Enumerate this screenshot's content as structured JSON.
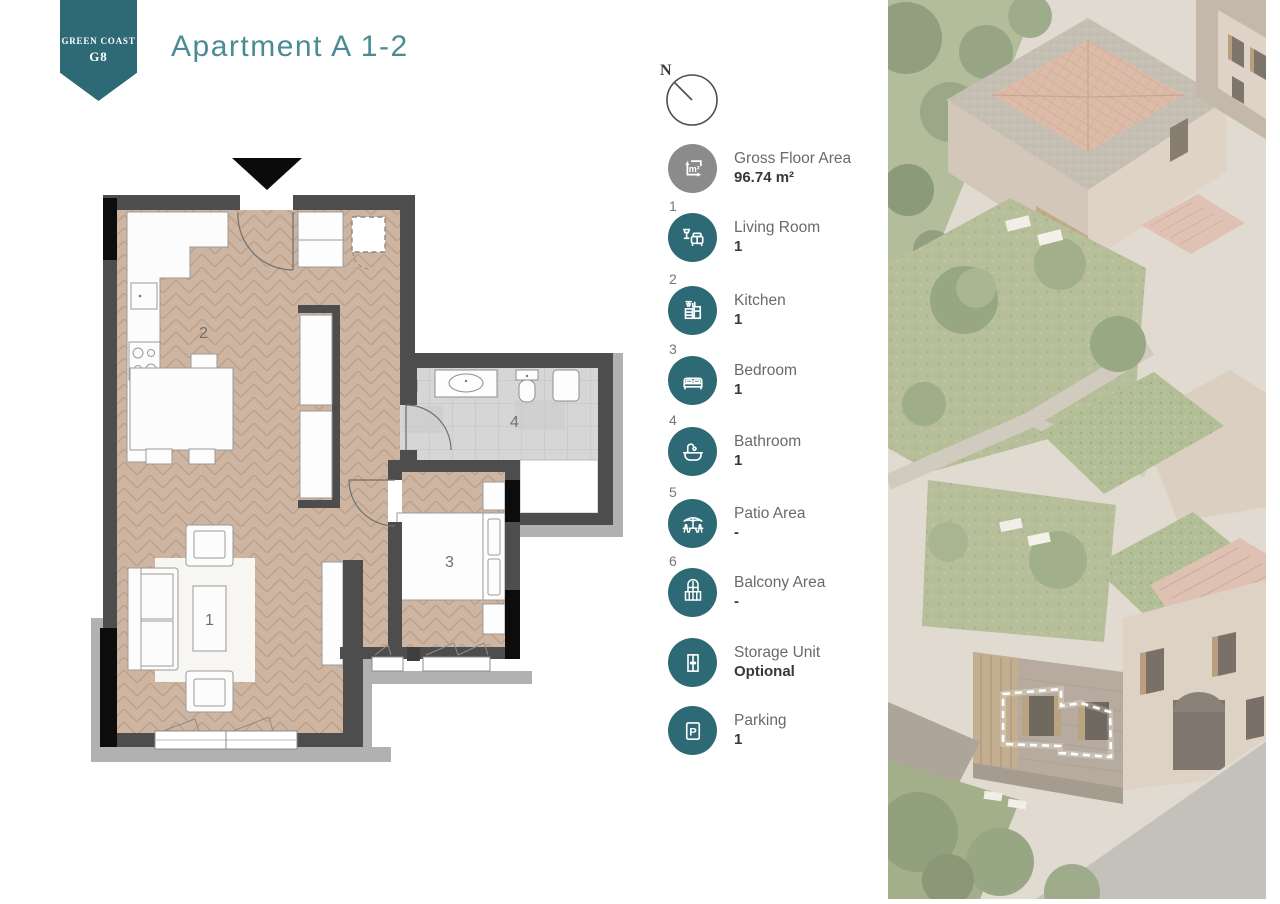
{
  "badge": {
    "line1": "GREEN COAST",
    "line2": "G8"
  },
  "title": "Apartment A 1-2",
  "compass": {
    "label": "N"
  },
  "legend": {
    "gfa": {
      "num": "",
      "label": "Gross Floor Area",
      "value": "96.74 m²",
      "icon": "area-icon"
    },
    "items": [
      {
        "num": "1",
        "label": "Living Room",
        "value": "1",
        "icon": "living-room-icon"
      },
      {
        "num": "2",
        "label": "Kitchen",
        "value": "1",
        "icon": "kitchen-icon"
      },
      {
        "num": "3",
        "label": "Bedroom",
        "value": "1",
        "icon": "bedroom-icon"
      },
      {
        "num": "4",
        "label": "Bathroom",
        "value": "1",
        "icon": "bathroom-icon"
      },
      {
        "num": "5",
        "label": "Patio Area",
        "value": "-",
        "icon": "patio-icon"
      },
      {
        "num": "6",
        "label": "Balcony Area",
        "value": "-",
        "icon": "balcony-icon"
      },
      {
        "num": "",
        "label": "Storage Unit",
        "value": "Optional",
        "icon": "storage-icon"
      },
      {
        "num": "",
        "label": "Parking",
        "value": "1",
        "icon": "parking-icon"
      }
    ],
    "parking_letter": "P"
  },
  "floorplan": {
    "labels": {
      "living": "1",
      "kitchen": "2",
      "bedroom": "3",
      "bathroom": "4"
    }
  },
  "colors": {
    "teal": "#2d6a75",
    "title_teal": "#4b8b95",
    "icon_gray": "#8b8b8b",
    "wall": "#4d4d4d",
    "wall_black": "#0c0c0c",
    "wood": "#cdb5a2",
    "tile": "#d7d7d7",
    "ledge": "#b3b1af"
  }
}
